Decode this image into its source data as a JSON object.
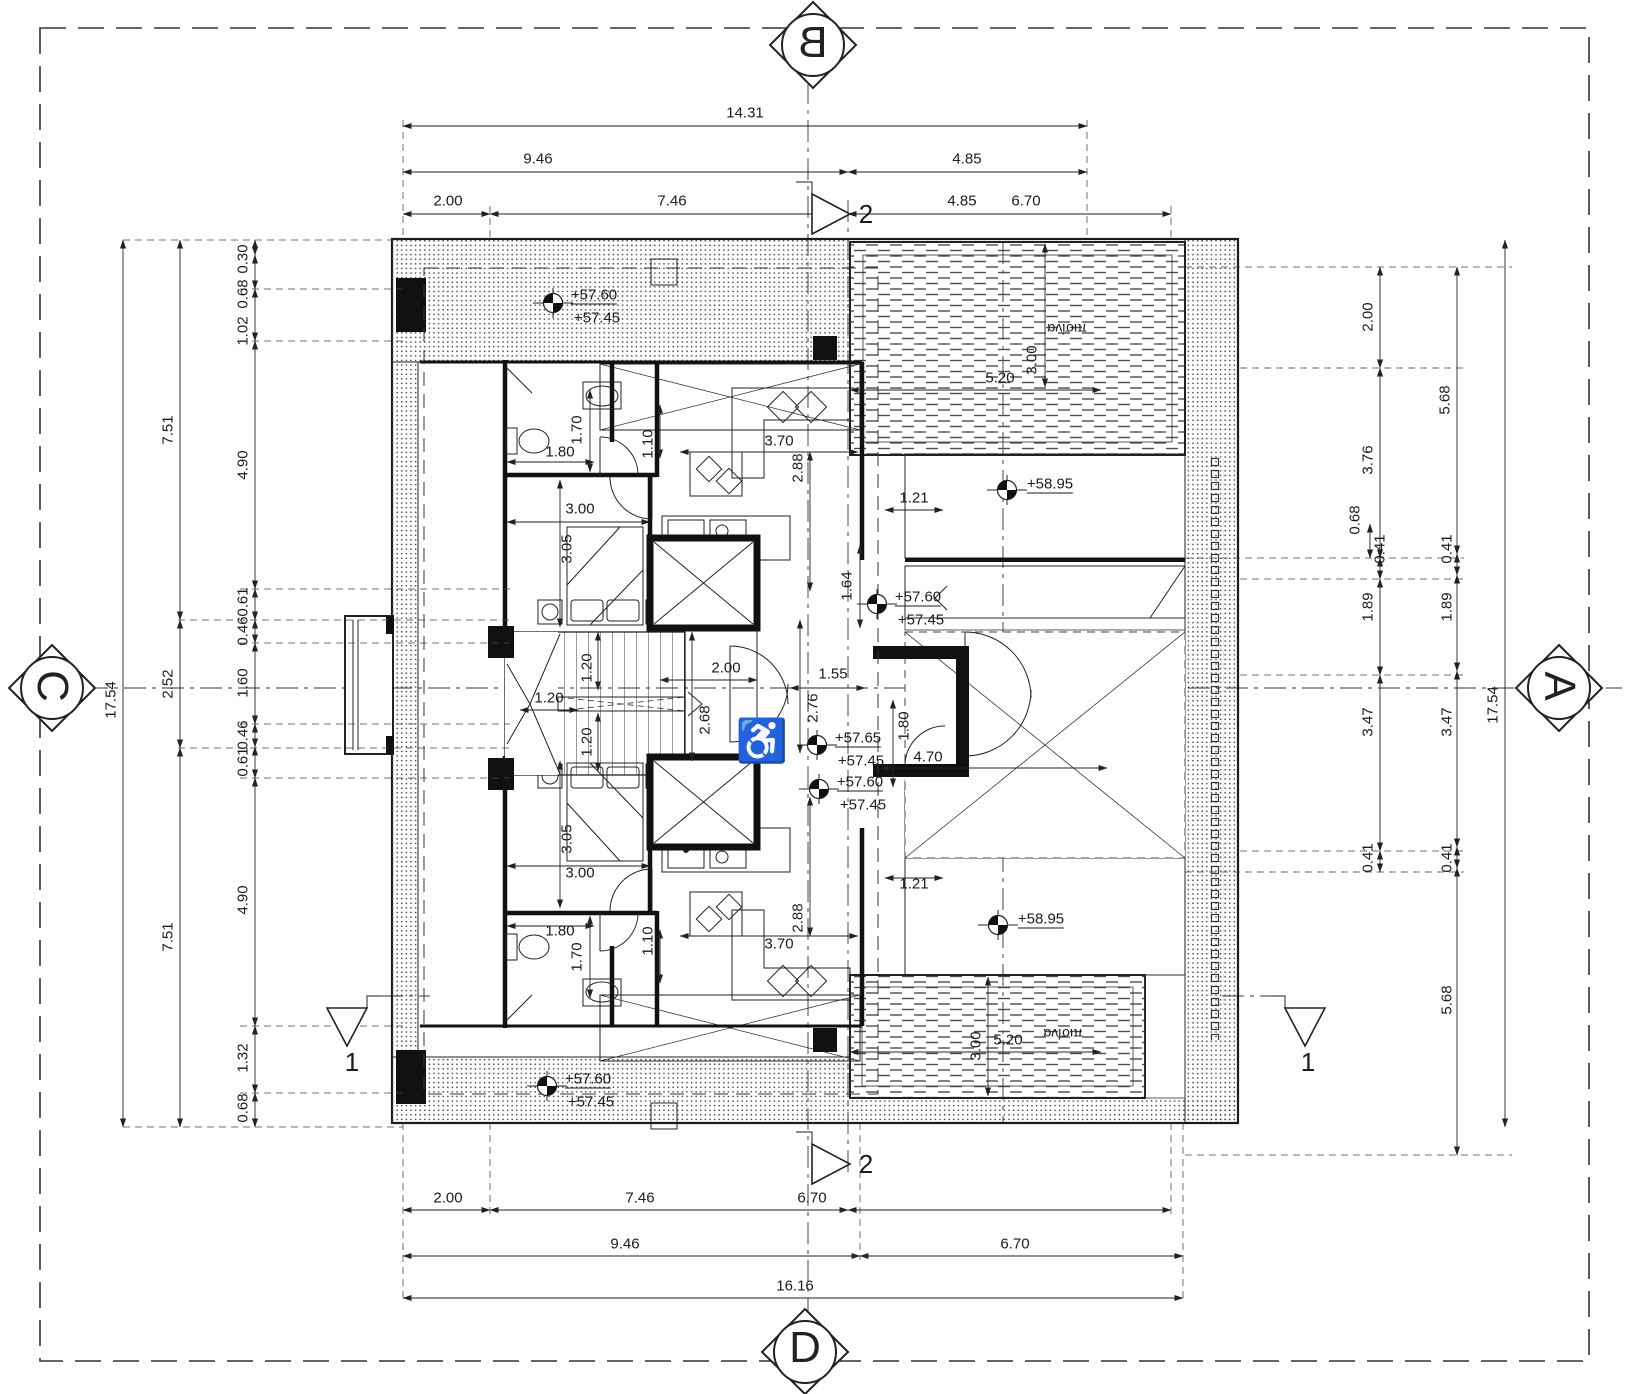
{
  "drawing_type": "architectural roof/penthouse floor plan",
  "colors": {
    "paper": "#ffffff",
    "ink": "#1b1b1b"
  },
  "markers": {
    "b": "B",
    "c": "C",
    "a": "A",
    "d": "D"
  },
  "labels": {
    "sections": [
      {
        "t": "2",
        "x": 866,
        "y": 214,
        "s": 26,
        "n": "section-marker-2-top"
      },
      {
        "t": "2",
        "x": 866,
        "y": 1164,
        "s": 26,
        "n": "section-marker-2-bottom"
      },
      {
        "t": "1",
        "x": 352,
        "y": 1062,
        "s": 26,
        "n": "section-marker-1-left"
      },
      {
        "t": "1",
        "x": 1308,
        "y": 1062,
        "s": 26,
        "n": "section-marker-1-right"
      }
    ],
    "dims_top": [
      {
        "t": "14.31",
        "x": 745,
        "y": 113
      },
      {
        "t": "9.46",
        "x": 538,
        "y": 159
      },
      {
        "t": "4.85",
        "x": 967,
        "y": 159
      },
      {
        "t": "2.00",
        "x": 448,
        "y": 201
      },
      {
        "t": "7.46",
        "x": 672,
        "y": 201
      },
      {
        "t": "4.85",
        "x": 962,
        "y": 201
      },
      {
        "t": "6.70",
        "x": 1026,
        "y": 201
      }
    ],
    "dims_bottom": [
      {
        "t": "2.00",
        "x": 448,
        "y": 1198
      },
      {
        "t": "7.46",
        "x": 640,
        "y": 1198
      },
      {
        "t": "6.70",
        "x": 812,
        "y": 1198
      },
      {
        "t": "9.46",
        "x": 625,
        "y": 1244
      },
      {
        "t": "6.70",
        "x": 1015,
        "y": 1244
      },
      {
        "t": "16.16",
        "x": 795,
        "y": 1286
      }
    ],
    "dims_left": [
      {
        "t": "17.54",
        "x": 111,
        "y": 700,
        "r": -90
      },
      {
        "t": "7.51",
        "x": 168,
        "y": 430,
        "r": -90
      },
      {
        "t": "2.52",
        "x": 168,
        "y": 684,
        "r": -90
      },
      {
        "t": "7.51",
        "x": 168,
        "y": 937,
        "r": -90
      },
      {
        "t": "0.30",
        "x": 243,
        "y": 259,
        "r": -90
      },
      {
        "t": "0.68",
        "x": 243,
        "y": 294,
        "r": -90
      },
      {
        "t": "1.02",
        "x": 243,
        "y": 331,
        "r": -90
      },
      {
        "t": "4.90",
        "x": 243,
        "y": 465,
        "r": -90
      },
      {
        "t": "0.61",
        "x": 243,
        "y": 602,
        "r": -90
      },
      {
        "t": "0.46",
        "x": 243,
        "y": 631,
        "r": -90
      },
      {
        "t": "1.60",
        "x": 243,
        "y": 683,
        "r": -90
      },
      {
        "t": "0.46",
        "x": 243,
        "y": 735,
        "r": -90
      },
      {
        "t": "0.61",
        "x": 243,
        "y": 762,
        "r": -90
      },
      {
        "t": "4.90",
        "x": 243,
        "y": 900,
        "r": -90
      },
      {
        "t": "1.32",
        "x": 243,
        "y": 1058,
        "r": -90
      },
      {
        "t": "0.68",
        "x": 243,
        "y": 1108,
        "r": -90
      }
    ],
    "dims_right": [
      {
        "t": "17.54",
        "x": 1493,
        "y": 705,
        "r": -90
      },
      {
        "t": "2.00",
        "x": 1368,
        "y": 317,
        "r": -90
      },
      {
        "t": "3.76",
        "x": 1368,
        "y": 460,
        "r": -90
      },
      {
        "t": "0.68",
        "x": 1355,
        "y": 520,
        "r": -90
      },
      {
        "t": "0.41",
        "x": 1380,
        "y": 549,
        "r": -90
      },
      {
        "t": "1.89",
        "x": 1368,
        "y": 607,
        "r": -90
      },
      {
        "t": "3.47",
        "x": 1368,
        "y": 722,
        "r": -90
      },
      {
        "t": "0.41",
        "x": 1368,
        "y": 858,
        "r": -90
      },
      {
        "t": "5.68",
        "x": 1445,
        "y": 400,
        "r": -90
      },
      {
        "t": "0.41",
        "x": 1447,
        "y": 549,
        "r": -90
      },
      {
        "t": "1.89",
        "x": 1447,
        "y": 607,
        "r": -90
      },
      {
        "t": "3.47",
        "x": 1447,
        "y": 722,
        "r": -90
      },
      {
        "t": "0.41",
        "x": 1447,
        "y": 858,
        "r": -90
      },
      {
        "t": "5.68",
        "x": 1447,
        "y": 1000,
        "r": -90
      }
    ],
    "dims_interior_upper": [
      {
        "t": "1.70",
        "x": 577,
        "y": 430,
        "r": -90
      },
      {
        "t": "1.80",
        "x": 560,
        "y": 452
      },
      {
        "t": "1.10",
        "x": 648,
        "y": 444,
        "r": -90
      },
      {
        "t": "3.70",
        "x": 779,
        "y": 441
      },
      {
        "t": "2.88",
        "x": 798,
        "y": 468,
        "r": -90
      },
      {
        "t": "3.00",
        "x": 580,
        "y": 509
      },
      {
        "t": "3.05",
        "x": 567,
        "y": 549,
        "r": -90
      },
      {
        "t": "1.64",
        "x": 847,
        "y": 586,
        "r": -90
      },
      {
        "t": "1.21",
        "x": 914,
        "y": 498
      }
    ],
    "dims_interior_core": [
      {
        "t": "1.20",
        "x": 549,
        "y": 698
      },
      {
        "t": "1.20",
        "x": 587,
        "y": 668,
        "r": -90
      },
      {
        "t": "1.20",
        "x": 587,
        "y": 742,
        "r": -90
      },
      {
        "t": "2.68",
        "x": 705,
        "y": 720,
        "r": -90
      },
      {
        "t": "2.00",
        "x": 726,
        "y": 668
      },
      {
        "t": "1.55",
        "x": 833,
        "y": 674
      },
      {
        "t": "2.76",
        "x": 813,
        "y": 708,
        "r": -90
      },
      {
        "t": "1.80",
        "x": 904,
        "y": 726,
        "r": -90
      },
      {
        "t": "4.70",
        "x": 928,
        "y": 757
      }
    ],
    "dims_interior_lower": [
      {
        "t": "3.05",
        "x": 567,
        "y": 839,
        "r": -90
      },
      {
        "t": "3.00",
        "x": 580,
        "y": 873
      },
      {
        "t": "1.80",
        "x": 560,
        "y": 931
      },
      {
        "t": "1.70",
        "x": 577,
        "y": 957,
        "r": -90
      },
      {
        "t": "1.10",
        "x": 648,
        "y": 941,
        "r": -90
      },
      {
        "t": "3.70",
        "x": 779,
        "y": 944
      },
      {
        "t": "2.88",
        "x": 798,
        "y": 918,
        "r": -90
      },
      {
        "t": "1.21",
        "x": 914,
        "y": 884
      }
    ],
    "dims_pools": [
      {
        "t": "5.20",
        "x": 1000,
        "y": 378
      },
      {
        "t": "3.00",
        "x": 1032,
        "y": 360,
        "r": -90
      },
      {
        "t": "5.20",
        "x": 1008,
        "y": 1040
      },
      {
        "t": "3.00",
        "x": 976,
        "y": 1046,
        "r": -90
      }
    ],
    "levels": [
      {
        "t": "+57.60",
        "x": 594,
        "y": 296,
        "u": true,
        "n": "level-roof-top"
      },
      {
        "t": "+57.45",
        "x": 597,
        "y": 318,
        "n": "level-roof-top-2"
      },
      {
        "t": "+57.60",
        "x": 918,
        "y": 598,
        "u": true,
        "n": "level-center-upper"
      },
      {
        "t": "+57.45",
        "x": 921,
        "y": 620,
        "n": "level-center-upper-2"
      },
      {
        "t": "+58.95",
        "x": 1050,
        "y": 485,
        "u": true,
        "n": "level-deck-top"
      },
      {
        "t": "+57.65",
        "x": 858,
        "y": 739,
        "u": true,
        "n": "level-center"
      },
      {
        "t": "+57.45",
        "x": 861,
        "y": 761,
        "n": "level-center-2"
      },
      {
        "t": "+57.60",
        "x": 860,
        "y": 783,
        "u": true,
        "n": "level-center-lower"
      },
      {
        "t": "+57.45",
        "x": 863,
        "y": 805,
        "n": "level-center-lower-2"
      },
      {
        "t": "+58.95",
        "x": 1041,
        "y": 920,
        "u": true,
        "n": "level-deck-bottom"
      },
      {
        "t": "+57.60",
        "x": 588,
        "y": 1080,
        "u": true,
        "n": "level-roof-bottom"
      },
      {
        "t": "+57.45",
        "x": 591,
        "y": 1102,
        "n": "level-roof-bottom-2"
      }
    ],
    "room_labels": [
      {
        "t": "πισίνα",
        "x": 1067,
        "y": 329,
        "r": 180,
        "s": 14,
        "n": "pool-label-top"
      },
      {
        "t": "πισίνα",
        "x": 1063,
        "y": 1034,
        "r": 180,
        "s": 14,
        "n": "pool-label-bottom"
      }
    ],
    "icons": [
      {
        "t": "♿",
        "x": 762,
        "y": 741,
        "s": 42,
        "n": "wheelchair-icon"
      }
    ]
  }
}
